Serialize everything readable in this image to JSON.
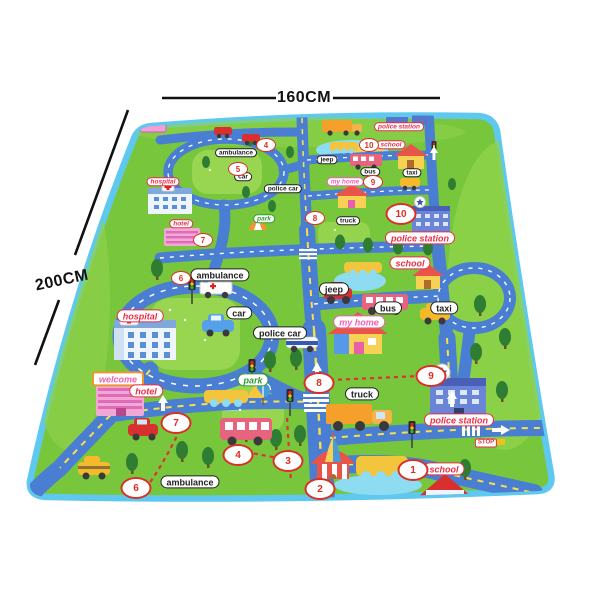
{
  "dimensions": {
    "width_label": "160CM",
    "length_label": "200CM"
  },
  "colors": {
    "mat_green": "#78c63c",
    "mat_green_light": "#8dd24a",
    "trim_blue": "#5fc8ef",
    "road_blue": "#4a7ed2",
    "road_dash_yellow": "#f7e04a",
    "pond_blue": "#8edcf2",
    "bridge_yellow": "#f2c53d",
    "tree_green": "#2e7d33",
    "label_red": "#e82f4a",
    "label_pink": "#f060b0",
    "label_green": "#2f9e2f",
    "label_dark": "#222222",
    "number_red": "#d93025",
    "dimension_text": "#111111"
  },
  "mat": {
    "labels": [
      {
        "text": "police station",
        "x": 399,
        "y": 127,
        "color": "red",
        "tier": "far"
      },
      {
        "text": "school",
        "x": 391,
        "y": 145,
        "color": "red",
        "tier": "far"
      },
      {
        "text": "ambulance",
        "x": 236,
        "y": 153,
        "color": "dark",
        "tier": "far"
      },
      {
        "text": "jeep",
        "x": 327,
        "y": 160,
        "color": "dark",
        "tier": "far"
      },
      {
        "text": "bus",
        "x": 370,
        "y": 172,
        "color": "dark",
        "tier": "far"
      },
      {
        "text": "taxi",
        "x": 412,
        "y": 173,
        "color": "dark",
        "tier": "far"
      },
      {
        "text": "car",
        "x": 243,
        "y": 177,
        "color": "dark",
        "tier": "far"
      },
      {
        "text": "my home",
        "x": 345,
        "y": 182,
        "color": "pink",
        "tier": "far"
      },
      {
        "text": "hospital",
        "x": 163,
        "y": 182,
        "color": "red",
        "tier": "far"
      },
      {
        "text": "police car",
        "x": 283,
        "y": 189,
        "color": "dark",
        "tier": "far"
      },
      {
        "text": "park",
        "x": 264,
        "y": 219,
        "color": "green",
        "tier": "far"
      },
      {
        "text": "truck",
        "x": 348,
        "y": 221,
        "color": "dark",
        "tier": "far"
      },
      {
        "text": "hotel",
        "x": 181,
        "y": 224,
        "color": "red",
        "tier": "far"
      },
      {
        "text": "police station",
        "x": 420,
        "y": 238,
        "color": "red",
        "tier": "near"
      },
      {
        "text": "school",
        "x": 410,
        "y": 263,
        "color": "red",
        "tier": "near"
      },
      {
        "text": "ambulance",
        "x": 220,
        "y": 275,
        "color": "dark",
        "tier": "near"
      },
      {
        "text": "jeep",
        "x": 334,
        "y": 289,
        "color": "dark",
        "tier": "near"
      },
      {
        "text": "bus",
        "x": 388,
        "y": 308,
        "color": "dark",
        "tier": "near"
      },
      {
        "text": "taxi",
        "x": 444,
        "y": 308,
        "color": "dark",
        "tier": "near"
      },
      {
        "text": "car",
        "x": 239,
        "y": 313,
        "color": "dark",
        "tier": "near"
      },
      {
        "text": "hospital",
        "x": 140,
        "y": 316,
        "color": "red",
        "tier": "near"
      },
      {
        "text": "my home",
        "x": 359,
        "y": 322,
        "color": "pink",
        "tier": "near"
      },
      {
        "text": "police car",
        "x": 280,
        "y": 333,
        "color": "dark",
        "tier": "near"
      },
      {
        "text": "welcome",
        "x": 118,
        "y": 379,
        "color": "pink",
        "tier": "near",
        "kind": "sign"
      },
      {
        "text": "park",
        "x": 253,
        "y": 380,
        "color": "green",
        "tier": "near"
      },
      {
        "text": "hotel",
        "x": 146,
        "y": 391,
        "color": "red",
        "tier": "near"
      },
      {
        "text": "truck",
        "x": 362,
        "y": 394,
        "color": "dark",
        "tier": "near"
      },
      {
        "text": "police station",
        "x": 459,
        "y": 420,
        "color": "red",
        "tier": "near"
      },
      {
        "text": "STOP",
        "x": 486,
        "y": 443,
        "color": "red",
        "tier": "near",
        "kind": "stop"
      },
      {
        "text": "school",
        "x": 444,
        "y": 469,
        "color": "red",
        "tier": "near"
      },
      {
        "text": "ambulance",
        "x": 190,
        "y": 482,
        "color": "dark",
        "tier": "near"
      }
    ],
    "route_numbers": [
      {
        "n": "10",
        "x": 369,
        "y": 145,
        "tier": "far"
      },
      {
        "n": "4",
        "x": 266,
        "y": 145,
        "tier": "far"
      },
      {
        "n": "5",
        "x": 238,
        "y": 169,
        "tier": "far"
      },
      {
        "n": "9",
        "x": 373,
        "y": 182,
        "tier": "far"
      },
      {
        "n": "8",
        "x": 315,
        "y": 218,
        "tier": "far"
      },
      {
        "n": "7",
        "x": 203,
        "y": 240,
        "tier": "far"
      },
      {
        "n": "6",
        "x": 181,
        "y": 278,
        "tier": "far"
      },
      {
        "n": "10",
        "x": 401,
        "y": 214,
        "tier": "near"
      },
      {
        "n": "9",
        "x": 431,
        "y": 376,
        "tier": "near"
      },
      {
        "n": "8",
        "x": 319,
        "y": 383,
        "tier": "near"
      },
      {
        "n": "7",
        "x": 176,
        "y": 423,
        "tier": "near"
      },
      {
        "n": "4",
        "x": 238,
        "y": 455,
        "tier": "near"
      },
      {
        "n": "3",
        "x": 288,
        "y": 461,
        "tier": "near"
      },
      {
        "n": "1",
        "x": 413,
        "y": 470,
        "tier": "near"
      },
      {
        "n": "6",
        "x": 136,
        "y": 488,
        "tier": "near"
      },
      {
        "n": "2",
        "x": 320,
        "y": 489,
        "tier": "near"
      }
    ]
  }
}
